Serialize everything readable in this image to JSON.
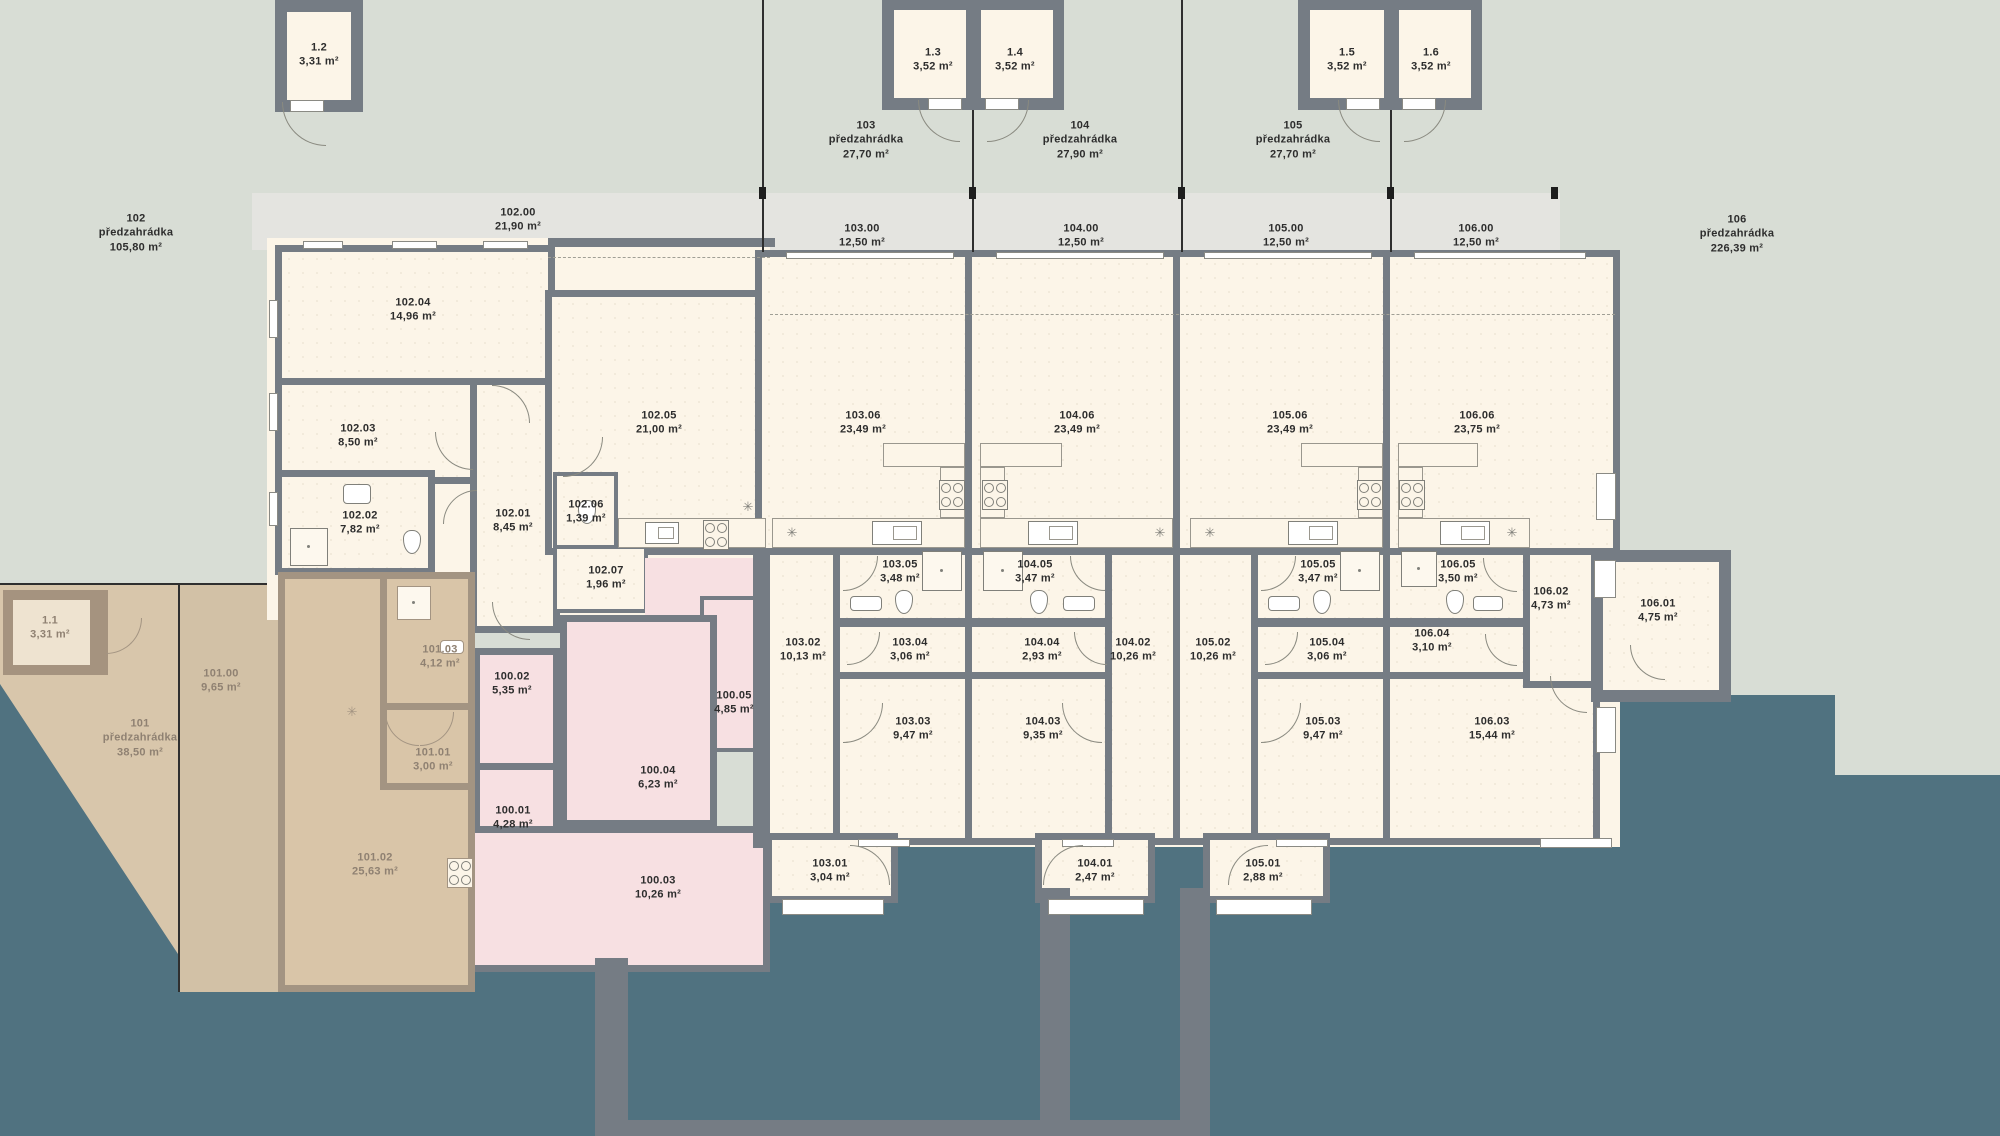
{
  "colors": {
    "background_sage": "#d8ddd5",
    "paving_teal": "#507280",
    "terrace_grey": "#e4e4e0",
    "wall_grey": "#757c84",
    "room_cream": "#fcf5e8",
    "shared_pink": "#f7e0e2",
    "garden_tan": "#d9c5a8",
    "tan_wall": "#a39482",
    "label_dark": "#2d2d2d",
    "label_muted": "#8f8172"
  },
  "gardens": [
    {
      "id": "102",
      "label": "předzahrádka",
      "area": "105,80 m²",
      "x": 136,
      "y": 233
    },
    {
      "id": "103",
      "label": "předzahrádka",
      "area": "27,70 m²",
      "x": 866,
      "y": 140
    },
    {
      "id": "104",
      "label": "předzahrádka",
      "area": "27,90 m²",
      "x": 1080,
      "y": 140
    },
    {
      "id": "105",
      "label": "předzahrádka",
      "area": "27,70 m²",
      "x": 1293,
      "y": 140
    },
    {
      "id": "106",
      "label": "předzahrádka",
      "area": "226,39 m²",
      "x": 1737,
      "y": 234
    },
    {
      "id": "101",
      "label": "předzahrádka",
      "area": "38,50 m²",
      "x": 140,
      "y": 738,
      "cls": "muted"
    }
  ],
  "labels": [
    {
      "id": "1.2",
      "area": "3,31 m²",
      "x": 319,
      "y": 55
    },
    {
      "id": "1.3",
      "area": "3,52 m²",
      "x": 933,
      "y": 60
    },
    {
      "id": "1.4",
      "area": "3,52 m²",
      "x": 1015,
      "y": 60
    },
    {
      "id": "1.5",
      "area": "3,52 m²",
      "x": 1347,
      "y": 60
    },
    {
      "id": "1.6",
      "area": "3,52 m²",
      "x": 1431,
      "y": 60
    },
    {
      "id": "1.1",
      "area": "3,31 m²",
      "x": 50,
      "y": 628,
      "cls": "muted"
    },
    {
      "id": "102.00",
      "area": "21,90 m²",
      "x": 518,
      "y": 220
    },
    {
      "id": "103.00",
      "area": "12,50 m²",
      "x": 862,
      "y": 236
    },
    {
      "id": "104.00",
      "area": "12,50 m²",
      "x": 1081,
      "y": 236
    },
    {
      "id": "105.00",
      "area": "12,50 m²",
      "x": 1286,
      "y": 236
    },
    {
      "id": "106.00",
      "area": "12,50 m²",
      "x": 1476,
      "y": 236
    },
    {
      "id": "102.04",
      "area": "14,96 m²",
      "x": 413,
      "y": 310
    },
    {
      "id": "102.03",
      "area": "8,50 m²",
      "x": 358,
      "y": 436
    },
    {
      "id": "102.02",
      "area": "7,82 m²",
      "x": 360,
      "y": 523
    },
    {
      "id": "102.01",
      "area": "8,45 m²",
      "x": 513,
      "y": 521
    },
    {
      "id": "102.05",
      "area": "21,00 m²",
      "x": 659,
      "y": 423
    },
    {
      "id": "102.06",
      "area": "1,39 m²",
      "x": 586,
      "y": 512
    },
    {
      "id": "102.07",
      "area": "1,96 m²",
      "x": 606,
      "y": 578
    },
    {
      "id": "103.06",
      "area": "23,49 m²",
      "x": 863,
      "y": 423
    },
    {
      "id": "103.05",
      "area": "3,48 m²",
      "x": 900,
      "y": 572
    },
    {
      "id": "103.04",
      "area": "3,06 m²",
      "x": 910,
      "y": 650
    },
    {
      "id": "103.03",
      "area": "9,47 m²",
      "x": 913,
      "y": 729
    },
    {
      "id": "103.02",
      "area": "10,13 m²",
      "x": 803,
      "y": 650
    },
    {
      "id": "103.01",
      "area": "3,04 m²",
      "x": 830,
      "y": 871
    },
    {
      "id": "104.06",
      "area": "23,49 m²",
      "x": 1077,
      "y": 423
    },
    {
      "id": "104.05",
      "area": "3,47 m²",
      "x": 1035,
      "y": 572
    },
    {
      "id": "104.04",
      "area": "2,93 m²",
      "x": 1042,
      "y": 650
    },
    {
      "id": "104.03",
      "area": "9,35 m²",
      "x": 1043,
      "y": 729
    },
    {
      "id": "104.02",
      "area": "10,26 m²",
      "x": 1133,
      "y": 650
    },
    {
      "id": "104.01",
      "area": "2,47 m²",
      "x": 1095,
      "y": 871
    },
    {
      "id": "105.06",
      "area": "23,49 m²",
      "x": 1290,
      "y": 423
    },
    {
      "id": "105.05",
      "area": "3,47 m²",
      "x": 1318,
      "y": 572
    },
    {
      "id": "105.04",
      "area": "3,06 m²",
      "x": 1327,
      "y": 650
    },
    {
      "id": "105.03",
      "area": "9,47 m²",
      "x": 1323,
      "y": 729
    },
    {
      "id": "105.02",
      "area": "10,26 m²",
      "x": 1213,
      "y": 650
    },
    {
      "id": "105.01",
      "area": "2,88 m²",
      "x": 1263,
      "y": 871
    },
    {
      "id": "106.06",
      "area": "23,75 m²",
      "x": 1477,
      "y": 423
    },
    {
      "id": "106.05",
      "area": "3,50 m²",
      "x": 1458,
      "y": 572
    },
    {
      "id": "106.04",
      "area": "3,10 m²",
      "x": 1432,
      "y": 641
    },
    {
      "id": "106.03",
      "area": "15,44 m²",
      "x": 1492,
      "y": 729
    },
    {
      "id": "106.02",
      "area": "4,73 m²",
      "x": 1551,
      "y": 599
    },
    {
      "id": "106.01",
      "area": "4,75 m²",
      "x": 1658,
      "y": 611
    },
    {
      "id": "100.01",
      "area": "4,28 m²",
      "x": 513,
      "y": 818
    },
    {
      "id": "100.02",
      "area": "5,35 m²",
      "x": 512,
      "y": 684
    },
    {
      "id": "100.03",
      "area": "10,26 m²",
      "x": 658,
      "y": 888
    },
    {
      "id": "100.04",
      "area": "6,23 m²",
      "x": 658,
      "y": 778
    },
    {
      "id": "100.05",
      "area": "4,85 m²",
      "x": 734,
      "y": 703
    },
    {
      "id": "101.00",
      "area": "9,65 m²",
      "x": 221,
      "y": 681,
      "cls": "muted"
    },
    {
      "id": "101.01",
      "area": "3,00 m²",
      "x": 433,
      "y": 760,
      "cls": "muted"
    },
    {
      "id": "101.02",
      "area": "25,63 m²",
      "x": 375,
      "y": 865,
      "cls": "muted"
    },
    {
      "id": "101.03",
      "area": "4,12 m²",
      "x": 440,
      "y": 657,
      "cls": "muted"
    }
  ],
  "lamps": [
    {
      "glyph": "✳",
      "x": 748,
      "y": 507
    },
    {
      "glyph": "✳",
      "x": 792,
      "y": 533
    },
    {
      "glyph": "✳",
      "x": 1160,
      "y": 533
    },
    {
      "glyph": "✳",
      "x": 1210,
      "y": 533
    },
    {
      "glyph": "✳",
      "x": 1512,
      "y": 533
    },
    {
      "glyph": "✳",
      "x": 352,
      "y": 712,
      "cls": "muted"
    }
  ]
}
